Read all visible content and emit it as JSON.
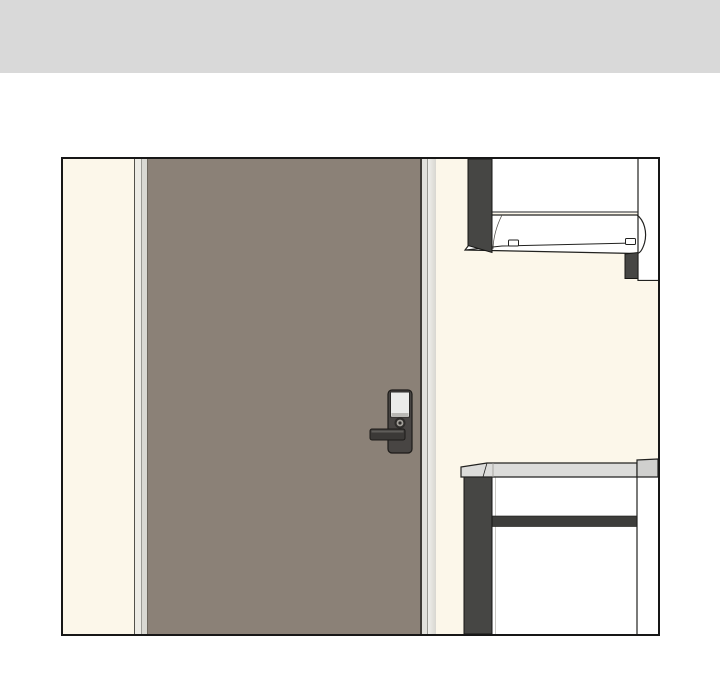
{
  "scene": {
    "kind": "webtoon-panel-illustration",
    "text_content": "",
    "objects": {
      "header_bar": "plain light gray divider band across the top of the page",
      "panel": "black-bordered rectangular comic panel on white page background",
      "door": "large flat taupe entry door filling the left two-thirds of the panel, closed, with frame strips on both sides",
      "door_lock": "dark electronic lock unit on right side of door with white keypad panel, round thumbturn and left-pointing lever handle",
      "wall": "cream interior wall",
      "wall_cabinet": "white kitchen wall cabinet / range hood with dark side pillar and curved lower front with two small latches, top right of panel",
      "counter": "light gray countertop over white base cabinet with dark side pillar and dark drawer gap, bottom right of panel"
    }
  },
  "colors": {
    "page_bg": "#ffffff",
    "header_bar": "#d9d9d9",
    "panel_border": "#171717",
    "wall_cream": "#fcf7ea",
    "door": "#8b8177",
    "door_edge": "#403c37",
    "door_hinge_edge": "#6d665c",
    "frame_dark_line": "#53514b",
    "frame_light": "#ecebe5",
    "frame_line": "#9b9a94",
    "frame_mid": "#d9d8d2",
    "frame_right_strip": "#e3e2dd",
    "frame_right_light": "#f0efeb",
    "frame_right_shade": "#d8d7d1",
    "structure_dark": "#464644",
    "band_dark": "#3d3d3b",
    "cabinet_white": "#ffffff",
    "counter_top": "#dcdcda",
    "counter_top_side": "#d0d0ce",
    "outline": "#222220",
    "hairline": "#161614",
    "lock_body": "#484543",
    "lock_outline": "#1d1b19",
    "lock_panel": "#ebebe9",
    "lock_panel_shade": "#b9b8b4",
    "lock_handle": "#3b3937",
    "lock_handle_hi": "#5f5d5a",
    "knob_dark": "#2e2c2a",
    "knob_mid": "#a3a09a"
  }
}
